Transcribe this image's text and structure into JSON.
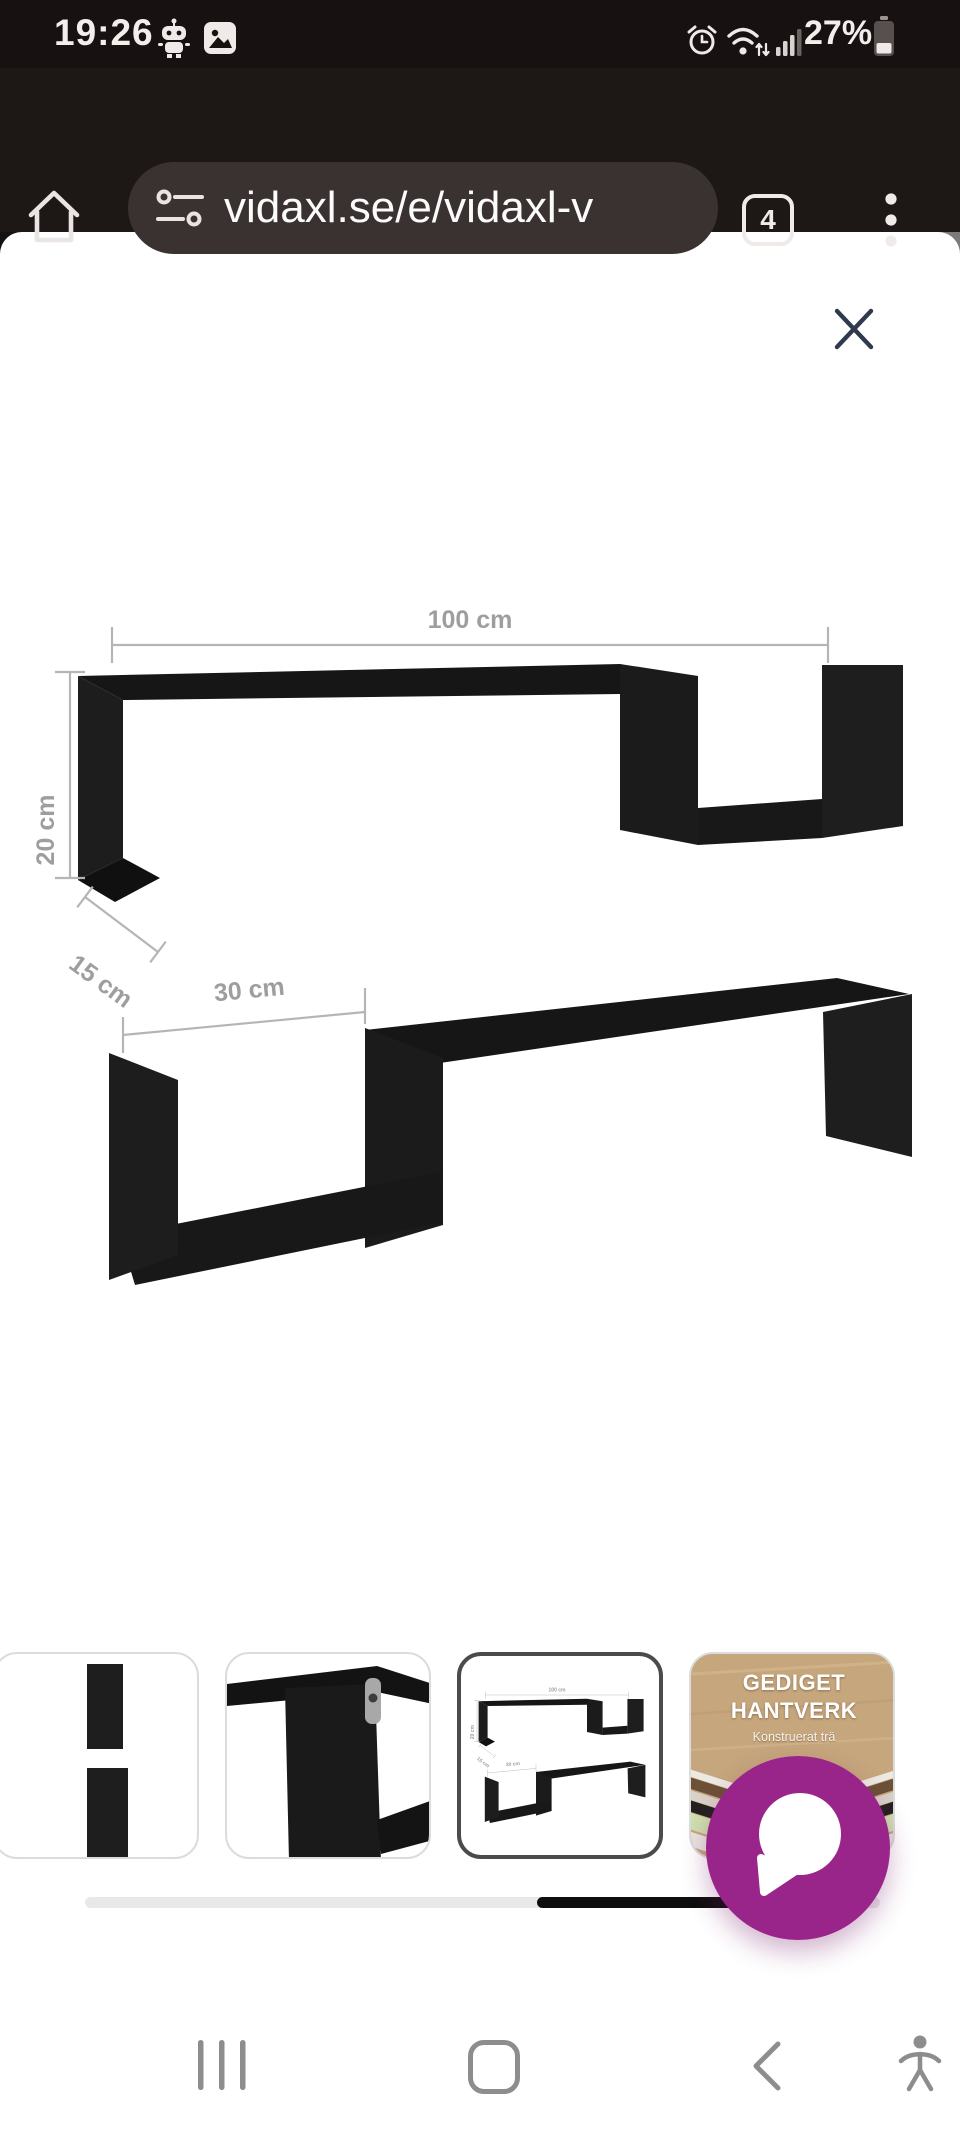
{
  "status_bar": {
    "time": "19:26",
    "battery_percent": "27%",
    "icons": [
      "robot-notification-icon",
      "gallery-notification-icon",
      "alarm-icon",
      "wifi-icon",
      "signal-icon",
      "battery-icon"
    ]
  },
  "browser_bar": {
    "url": "vidaxl.se/e/vidaxl-v",
    "tab_count": "4",
    "icons": [
      "home-icon",
      "tune-icon",
      "tabs-button",
      "overflow-menu-icon"
    ]
  },
  "image_viewer": {
    "close_icon": "close-x",
    "diagram": {
      "width_label": "100 cm",
      "height_label": "20 cm",
      "depth_label": "15 cm",
      "gap_label": "30 cm",
      "shelf_color": "#1b1b1b",
      "dimension_line_color": "#b5b5b5"
    }
  },
  "thumbnails": {
    "selected_index": 2,
    "items": [
      {
        "name": "shelf-photo-fragment"
      },
      {
        "name": "shelf-corner-closeup"
      },
      {
        "name": "dimension-diagram"
      },
      {
        "name": "material-info",
        "title_line1": "GEDIGET",
        "title_line2": "HANTVERK",
        "subtitle": "Konstruerat trä"
      }
    ]
  },
  "chat_fab": {
    "icon": "speech-bubble-icon",
    "color": "#99258a"
  },
  "nav_bar": {
    "icons": [
      "recents-icon",
      "home-button",
      "back-icon",
      "accessibility-icon"
    ]
  },
  "colors": {
    "status_bar_bg": "#171111",
    "address_bar_bg": "#1d1716",
    "url_pill_bg": "#3a3231",
    "close_x": "#303a4e",
    "thumb_border": "#dcdcdc",
    "thumb_border_selected": "#4b4b4b",
    "scroll_track": "#e9e7e7",
    "scroll_fill": "#0e0e0e",
    "nav_icon_gray": "#8d8d8d"
  }
}
